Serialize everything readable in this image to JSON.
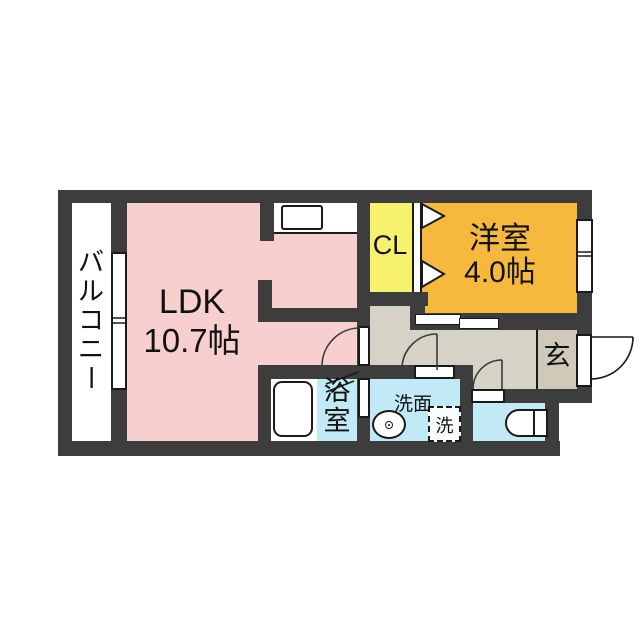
{
  "title": "apartment-floor-plan",
  "colors": {
    "wall": "#3d3d3d",
    "ldk_pink": "#f8cfcf",
    "closet_yellow": "#f7f26e",
    "western_room_orange": "#f6b93e",
    "hallway_beige": "#d6d2c5",
    "entrance_beige": "#cfc9ba",
    "wet_area_blue": "#c1eaf6",
    "outline": "#1a1a1a"
  },
  "rooms": {
    "balcony": {
      "label": "バルコニー",
      "chars": [
        "バ",
        "ル",
        "コ",
        "ニ",
        "ー"
      ]
    },
    "ldk": {
      "name": "LDK",
      "size": "10.7帖"
    },
    "closet": {
      "label": "CL"
    },
    "western_room": {
      "name": "洋室",
      "size": "4.0帖"
    },
    "bath": {
      "label": "浴室",
      "chars": [
        "浴",
        "室"
      ]
    },
    "washroom": {
      "label": "洗面"
    },
    "laundry": {
      "label": "洗"
    },
    "entrance": {
      "label": "玄"
    }
  }
}
